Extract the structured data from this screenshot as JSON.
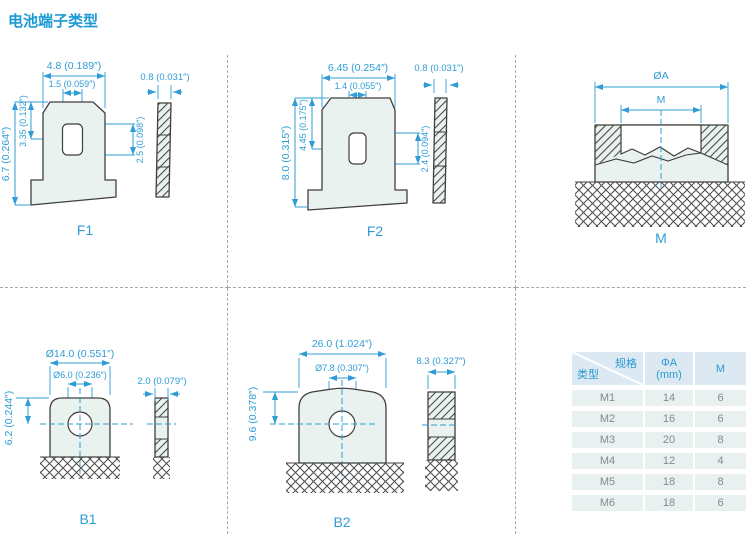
{
  "title": "电池端子类型",
  "panels": {
    "f1": {
      "label": "F1",
      "dims": {
        "top_width": "4.8 (0.189″)",
        "slot_width": "1.5 (0.059″)",
        "total_height": "6.7 (0.264″)",
        "upper_height": "3.35 (0.132″)",
        "slot_height": "2.5 (0.098″)",
        "thickness": "0.8 (0.031″)"
      }
    },
    "f2": {
      "label": "F2",
      "dims": {
        "top_width": "6.45 (0.254″)",
        "slot_width": "1.4 (0.055″)",
        "total_height": "8.0 (0.315″)",
        "upper_height": "4.45 (0.175″)",
        "slot_height": "2.4 (0.094″)",
        "thickness": "0.8 (0.031″)"
      }
    },
    "m": {
      "label": "M",
      "dims": {
        "outer_diameter": "ØA",
        "thread_size": "M"
      }
    },
    "b1": {
      "label": "B1",
      "dims": {
        "outer_diameter": "Ø14.0 (0.551″)",
        "hole_diameter": "Ø6.0 (0.236″)",
        "height": "6.2 (0.244″)",
        "thickness": "2.0 (0.079″)"
      }
    },
    "b2": {
      "label": "B2",
      "dims": {
        "outer_width": "26.0 (1.024″)",
        "hole_diameter": "Ø7.8 (0.307″)",
        "height": "9.6 (0.378″)",
        "thickness": "8.3 (0.327″)"
      }
    }
  },
  "spec_table": {
    "corner": {
      "top_right": "规格",
      "bottom_left": "类型"
    },
    "columns": {
      "phi_a_line1": "ΦA",
      "phi_a_line2": "(mm)",
      "m": "M"
    },
    "rows": [
      {
        "type": "M1",
        "phi_a": "14",
        "m": "6"
      },
      {
        "type": "M2",
        "phi_a": "16",
        "m": "6"
      },
      {
        "type": "M3",
        "phi_a": "20",
        "m": "8"
      },
      {
        "type": "M4",
        "phi_a": "12",
        "m": "4"
      },
      {
        "type": "M5",
        "phi_a": "18",
        "m": "8"
      },
      {
        "type": "M6",
        "phi_a": "18",
        "m": "6"
      }
    ]
  },
  "colors": {
    "accent_blue": "#1b9ad6",
    "dimension_blue": "#2f9cd6",
    "shape_fill": "#e9f2ee",
    "table_header_bg": "#dce9f2",
    "table_row_bg": "#e9f1f0"
  }
}
